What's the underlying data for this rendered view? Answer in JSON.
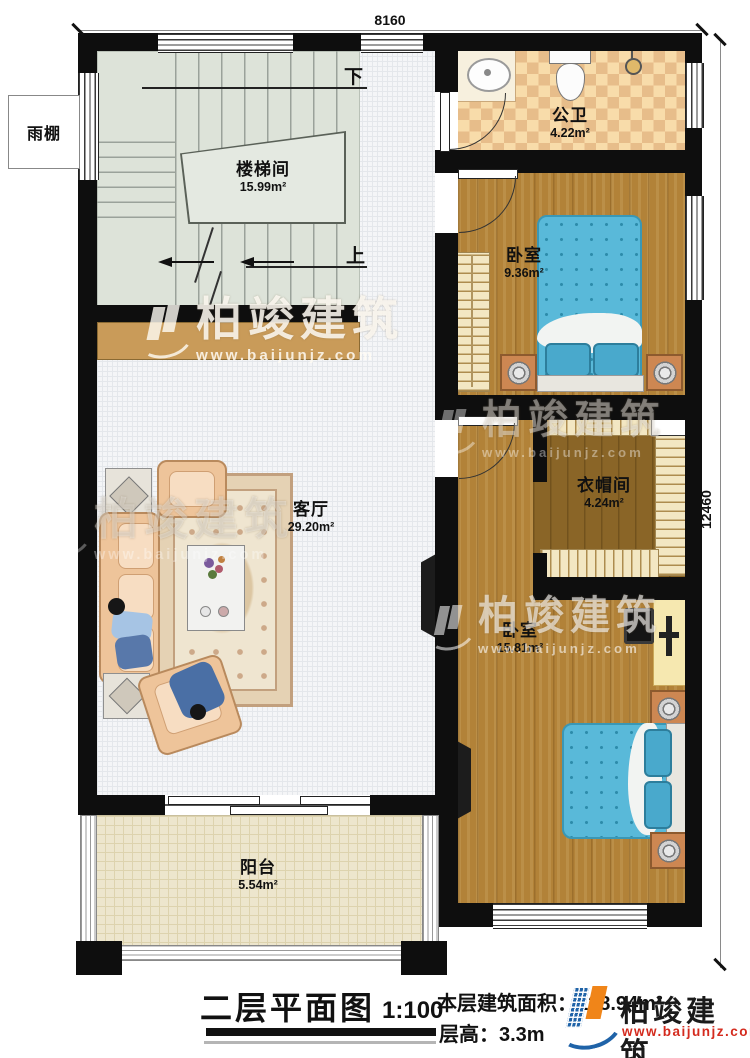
{
  "dimensions": {
    "top": "8160",
    "right": "12460"
  },
  "rooms": {
    "stairwell": {
      "name": "楼梯间",
      "area": "15.99m²"
    },
    "bathroom": {
      "name": "公卫",
      "area": "4.22m²"
    },
    "bedroom1": {
      "name": "卧室",
      "area": "9.36m²"
    },
    "cloakroom": {
      "name": "衣帽间",
      "area": "4.24m²"
    },
    "bedroom2": {
      "name": "卧室",
      "area": "15.81m²"
    },
    "living": {
      "name": "客厅",
      "area": "29.20m²"
    },
    "balcony": {
      "name": "阳台",
      "area": "5.54m²"
    },
    "canopy": {
      "name": "雨棚"
    }
  },
  "stairs": {
    "down": "下",
    "up": "上"
  },
  "title_block": {
    "title": "二层平面图",
    "scale": "1:100",
    "area_line": "本层建筑面积：128.94m²",
    "height_line": "层高：3.3m"
  },
  "brand": {
    "name": "柏竣建筑",
    "site": "www.baijunjz.com"
  },
  "colors": {
    "wall": "#0e0e0e",
    "wood_floor": "#b28238",
    "cloakroom_floor": "#8a6527",
    "bath_tile_light": "#f8dcaa",
    "bath_tile_dark": "#e7bd8a",
    "bed_blue": "#59b9d9",
    "cabinet_tan": "#c99b59",
    "logo_blue": "#1f63a8",
    "logo_orange": "#f08519",
    "logo_red": "#d42b1e"
  }
}
